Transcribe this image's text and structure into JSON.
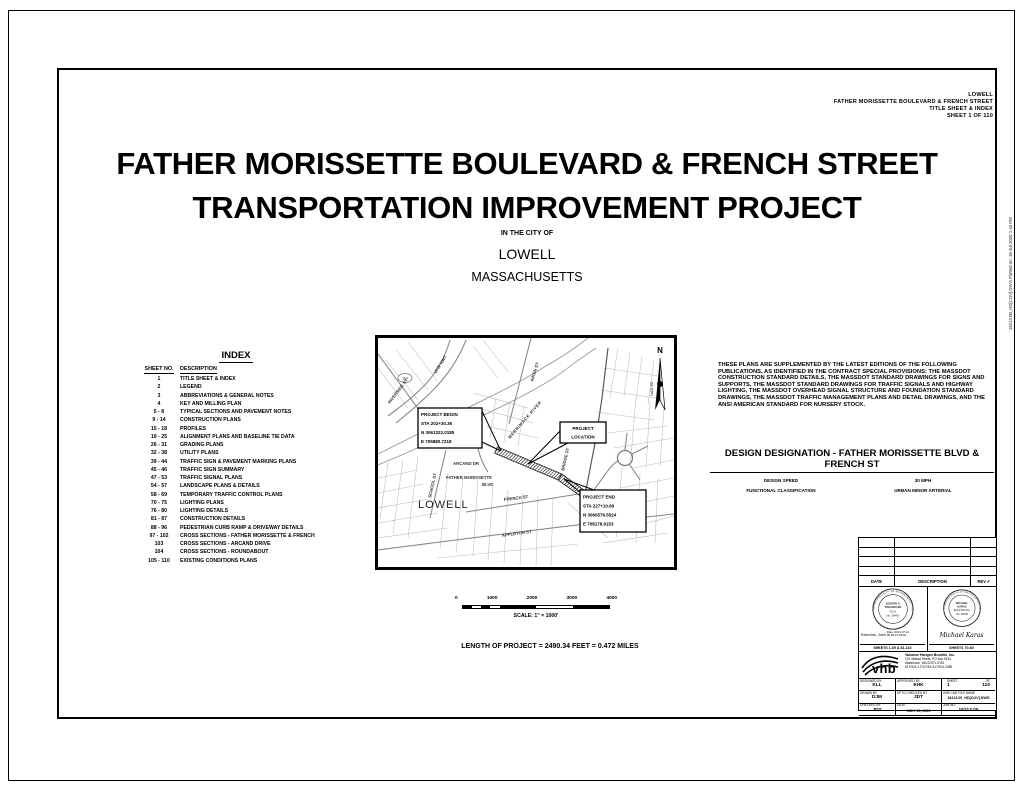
{
  "colors": {
    "ink": "#000000",
    "paper": "#ffffff",
    "street_gray": "#b0b0b0"
  },
  "margin_note": "16213.00_HD[COV].DWG      Plotted on: 16-Jul-2020  1:43 PM",
  "header_block": {
    "municipality": "LOWELL",
    "project": "FATHER MORISSETTE BOULEVARD & FRENCH STREET",
    "sheet_title": "TITLE SHEET & INDEX",
    "sheet_no": "SHEET 1 OF 110"
  },
  "title": {
    "line1": "FATHER MORISSETTE BOULEVARD & FRENCH STREET",
    "line2": "TRANSPORTATION IMPROVEMENT PROJECT",
    "in_city": "IN THE CITY OF",
    "city": "LOWELL",
    "state": "MASSACHUSETTS"
  },
  "index": {
    "title": "INDEX",
    "col_sheet": "SHEET NO.",
    "col_desc": "DESCRIPTION",
    "rows": [
      {
        "no": "1",
        "desc": "TITLE SHEET & INDEX"
      },
      {
        "no": "2",
        "desc": "LEGEND"
      },
      {
        "no": "3",
        "desc": "ABBREVIATIONS & GENERAL NOTES"
      },
      {
        "no": "4",
        "desc": "KEY AND MILLING PLAN"
      },
      {
        "no": "5 - 8",
        "desc": "TYPICAL SECTIONS AND PAVEMENT NOTES"
      },
      {
        "no": "9 - 14",
        "desc": "CONSTRUCTION PLANS"
      },
      {
        "no": "15 - 18",
        "desc": "PROFILES"
      },
      {
        "no": "19 - 25",
        "desc": "ALIGNMENT PLANS AND BASELINE TIE DATA"
      },
      {
        "no": "26 - 31",
        "desc": "GRADING PLANS"
      },
      {
        "no": "32 - 38",
        "desc": "UTILITY PLANS"
      },
      {
        "no": "39 - 44",
        "desc": "TRAFFIC SIGN & PAVEMENT MARKING PLANS"
      },
      {
        "no": "45 - 46",
        "desc": "TRAFFIC SIGN SUMMARY"
      },
      {
        "no": "47 - 53",
        "desc": "TRAFFIC SIGNAL PLANS"
      },
      {
        "no": "54 - 57",
        "desc": "LANDSCAPE PLANS & DETAILS"
      },
      {
        "no": "58 - 69",
        "desc": "TEMPORARY TRAFFIC CONTROL PLANS"
      },
      {
        "no": "70 - 75",
        "desc": "LIGHTING PLANS"
      },
      {
        "no": "76 - 80",
        "desc": "LIGHTING DETAILS"
      },
      {
        "no": "81 - 87",
        "desc": "CONSTRUCTION DETAILS"
      },
      {
        "no": "88 - 96",
        "desc": "PEDESTRIAN CURB RAMP & DRIVEWAY DETAILS"
      },
      {
        "no": "97 - 102",
        "desc": "CROSS SECTIONS - FATHER MORISSETTE & FRENCH"
      },
      {
        "no": "103",
        "desc": "CROSS SECTIONS - ARCAND DRIVE"
      },
      {
        "no": "104",
        "desc": "CROSS SECTIONS - ROUNDABOUT"
      },
      {
        "no": "105 - 110",
        "desc": "EXISTING CONDITIONS PLANS"
      }
    ]
  },
  "map": {
    "north": "N",
    "datum": "NAD 83",
    "city": "LOWELL",
    "shield": "110",
    "streets": {
      "riverside": "RIVERSIDE ST",
      "vfw": "VFW HWY",
      "aiken": "AIKEN ST",
      "river": "MERRIMACK RIVER",
      "school": "SCHOOL ST",
      "arcand": "ARCAND DR",
      "fm1": "FATHER MORISSETTE",
      "fm2": "BLVD",
      "french": "FRENCH ST",
      "bridge": "BRIDGE ST",
      "appleton": "APPLETON ST"
    },
    "callouts": {
      "begin": {
        "l1": "PROJECT BEGIN",
        "l2": "STA 202+30.35",
        "l3": "N 3061322.0185",
        "l4": "E 705880.7218"
      },
      "loc": {
        "l1": "PROJECT",
        "l2": "LOCATION"
      },
      "end": {
        "l1": "PROJECT END",
        "l2": "STA 227+10.69",
        "l3": "N 3060576.5524",
        "l4": "E 708178.9153"
      }
    }
  },
  "scale": {
    "t0": "0",
    "t1": "1000",
    "t2": "2000",
    "t3": "3000",
    "t4": "4000",
    "label": "SCALE: 1\" = 1000'"
  },
  "length_note": "LENGTH OF PROJECT = 2490.34 FEET = 0.472 MILES",
  "notes": "THESE PLANS ARE SUPPLEMENTED BY THE LATEST EDITIONS OF THE FOLLOWING PUBLICATIONS, AS IDENTIFIED IN THE CONTRACT SPECIAL PROVISIONS: THE MASSDOT CONSTRUCTION STANDARD DETAILS, THE MASSDOT STANDARD DRAWINGS FOR SIGNS AND SUPPORTS, THE MASSDOT STANDARD DRAWINGS FOR TRAFFIC SIGNALS AND HIGHWAY LIGHTING, THE MASSDOT OVERHEAD SIGNAL STRUCTURE AND FOUNDATION STANDARD DRAWINGS, THE MASSDOT TRAFFIC MANAGEMENT PLANS AND DETAIL DRAWINGS, AND THE ANSI AMERICAN STANDARD FOR NURSERY STOCK.",
  "design_designation": {
    "title": "DESIGN DESIGNATION - FATHER MORISSETTE BLVD & FRENCH ST",
    "speed_label": "DESIGN SPEED",
    "speed": "30 MPH",
    "func_label": "FUNCTIONAL CLASSIFICATION",
    "func": "URBAN MINOR ARTERIAL"
  },
  "revision_table": {
    "date": "DATE",
    "description": "DESCRIPTION",
    "rev": "REV #"
  },
  "stamps": {
    "left": {
      "arc": "COMMONWEALTH OF MASSACHUSETTS",
      "name1": "JOSEPH A.",
      "name2": "TREARCHIS",
      "discipline": "CIVIL",
      "number": "No. 39492",
      "signature": "Trearchis, Josh",
      "sig_date1": "Date: 2021.07.14",
      "sig_date2": "09:56:27-04'00'",
      "sheets": "SHEETS 1-69 & 81-110"
    },
    "right": {
      "arc": "COMMONWEALTH OF MASSACHUSETTS",
      "name1": "MICHAEL",
      "name2": "KARAS",
      "discipline": "ELECTRICAL",
      "number": "No. 38435",
      "signature": "Michael Karas",
      "sheets": "SHEETS 70-80"
    }
  },
  "company": {
    "logo_text": "vhb",
    "name": "Vanasse Hangen Brustlin, Inc.",
    "addr1": "101 Walnut Street, PO Box 9151",
    "addr2": "Watertown, MA 02471-9151",
    "phone": "617/924-1770  FAX 617/924-2286"
  },
  "fields": {
    "designed_label": "DESIGNED BY",
    "designed": "KLL",
    "approved_label": "APPROVED BY",
    "approved": "EHK",
    "sheet_label": "SHEET",
    "of_label": "OF",
    "sheet_no": "1",
    "sheet_total": "110",
    "drawn_label": "DRAWN BY",
    "drawn": "DJM",
    "dftg_label": "DFTG CHECKED BY",
    "dftg": "JDT",
    "cad_label": "VHB CAD FILE NAME",
    "cad": "16213.00_HD[COV].DWG",
    "checked_label": "CHECKED BY",
    "checked": "JDT",
    "date_label": "DATE",
    "date": "JULY 16, 2020",
    "job_label": "JOB NO.",
    "job": "16213.00"
  }
}
